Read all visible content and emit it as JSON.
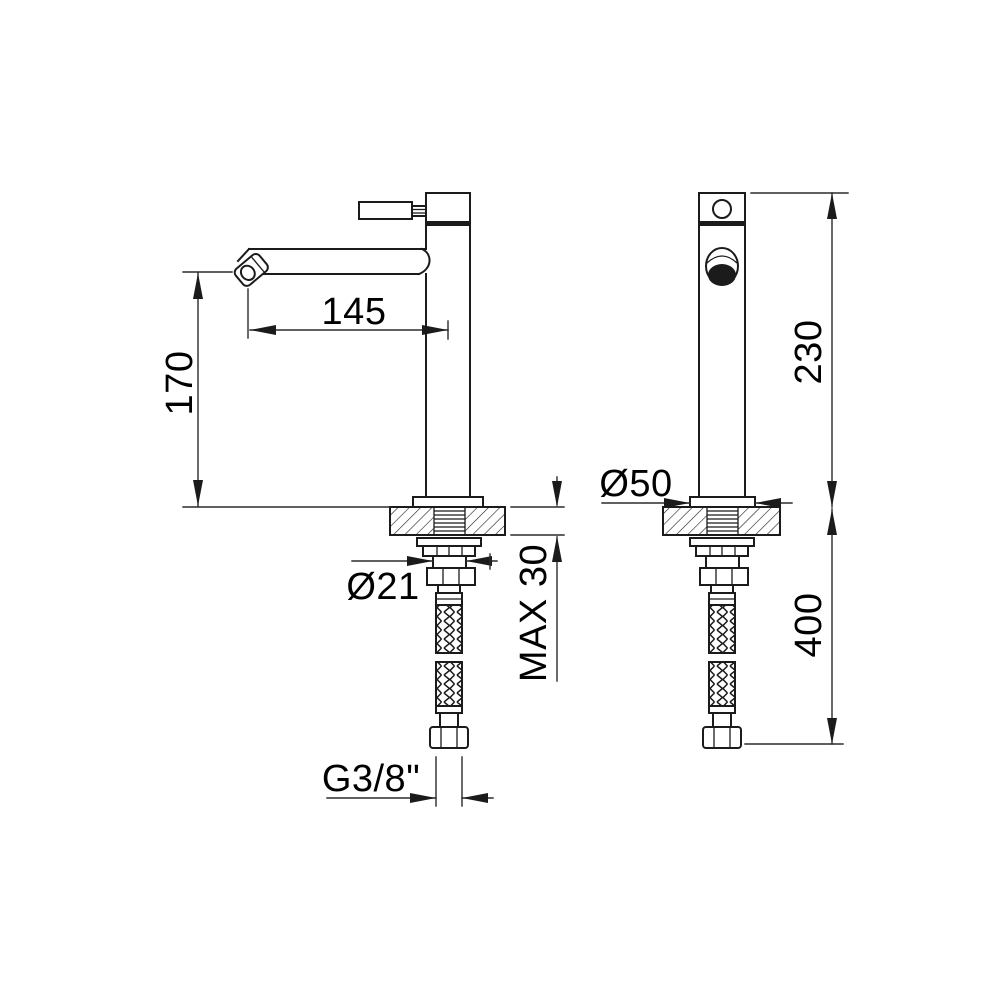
{
  "drawing": {
    "kind": "faucet installation technical drawing",
    "colors": {
      "line": "#1b1b1b",
      "background": "#ffffff"
    }
  },
  "dimensions": {
    "spout_reach": "145",
    "spout_height": "170",
    "body_height": "230",
    "base_diameter": "Ø50",
    "shank_diameter": "Ø21",
    "max_deck_thickness": "MAX 30",
    "hose_length": "400",
    "thread": "G3/8\""
  }
}
